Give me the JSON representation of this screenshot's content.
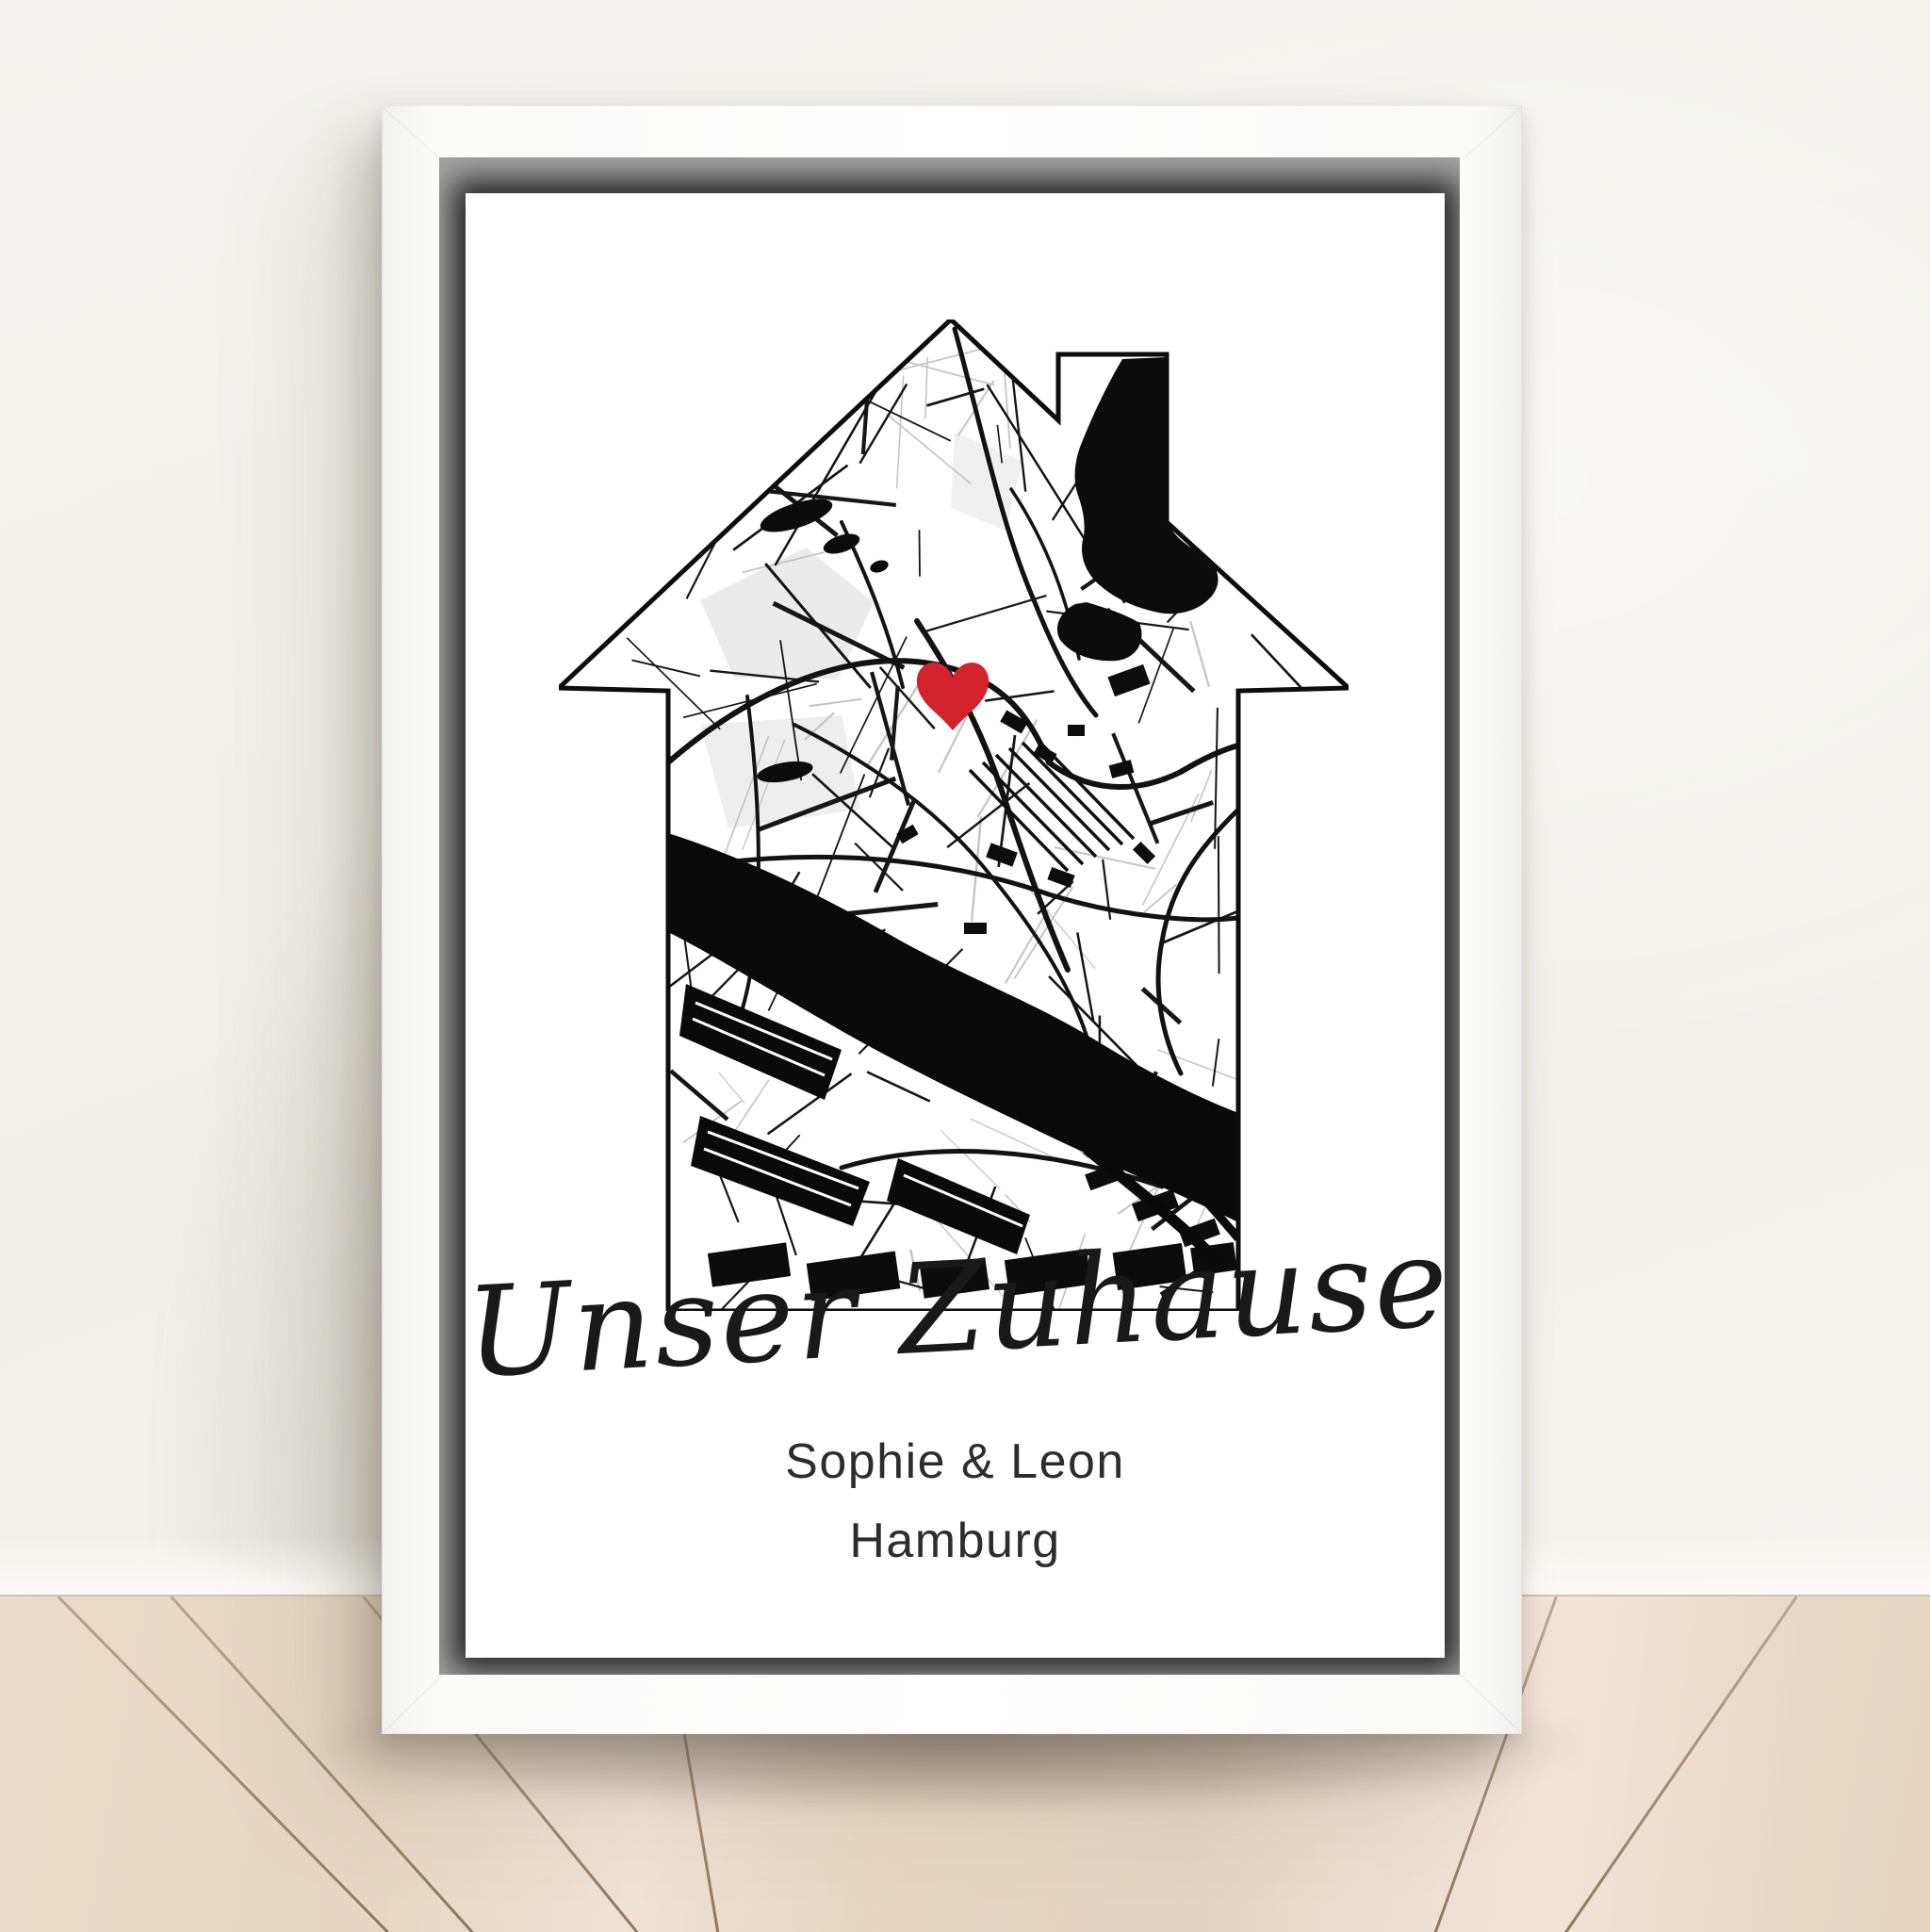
{
  "poster": {
    "title_script": "Unser Zuhause",
    "names_line": "Sophie & Leon",
    "city_line": "Hamburg",
    "map": {
      "heart_color": "#d2232c",
      "ink_color": "#111111",
      "paper_color": "#ffffff"
    }
  },
  "frame": {
    "face_color": "#ffffff",
    "shadow_gap_color": "#a4a4a4"
  },
  "room": {
    "wall_color": "#f2f0ec",
    "floor_color": "#e8d7c3",
    "floor_seam_color": "#a5886a"
  }
}
